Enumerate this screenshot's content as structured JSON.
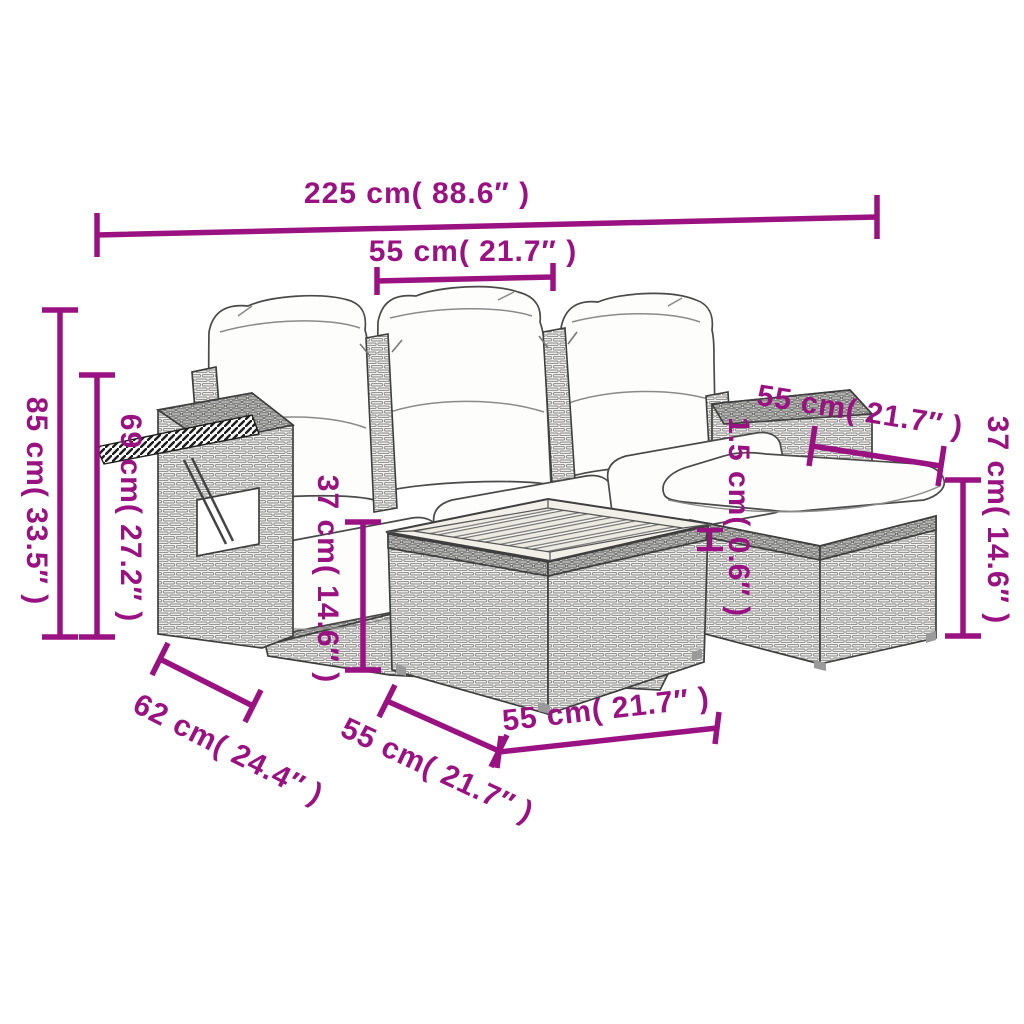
{
  "accent_color": "#9A1281",
  "diagram_title": "garden-furniture-set-dimensions",
  "dimensions": [
    {
      "id": "total-width",
      "label": "225 cm( 88.6″ )"
    },
    {
      "id": "seat-width",
      "label": "55 cm( 21.7″ )"
    },
    {
      "id": "total-height",
      "label": "85 cm( 33.5″ )"
    },
    {
      "id": "back-height",
      "label": "69 cm( 27.2″ )"
    },
    {
      "id": "seat-height",
      "label": "37 cm( 14.6″ )"
    },
    {
      "id": "armrest-width",
      "label": "55 cm( 21.7″ )"
    },
    {
      "id": "cushion-thickness",
      "label": "1.5 cm( 0.6″ )"
    },
    {
      "id": "stool-height",
      "label": "37 cm( 14.6″ )"
    },
    {
      "id": "seat-depth",
      "label": "62 cm( 24.4″ )"
    },
    {
      "id": "stool-width",
      "label": "55 cm( 21.7″ )"
    },
    {
      "id": "table-width",
      "label": "55 cm( 21.7″ )"
    }
  ]
}
